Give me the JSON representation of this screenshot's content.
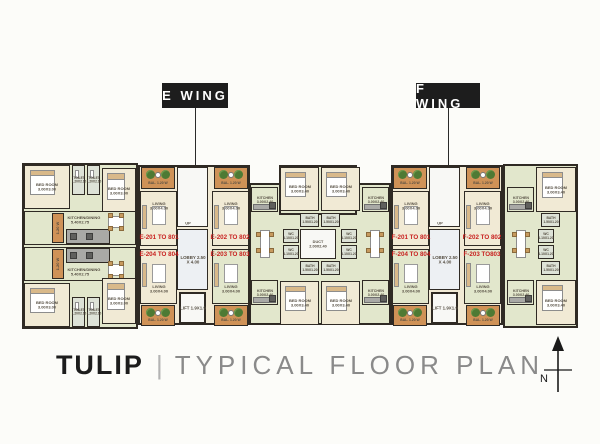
{
  "wing_labels": {
    "e": "E WING",
    "f": "F WING"
  },
  "title": {
    "name": "TULIP",
    "separator": "|",
    "subtitle": "TYPICAL FLOOR PLAN"
  },
  "north_label": "N",
  "colors": {
    "wall": "#2f2a24",
    "cream": "#f1ead5",
    "green": "#e2e7cc",
    "bal": "#cf9257",
    "bath": "#dde2d7",
    "white": "#f8f8f5",
    "lobby": "#edf0f3",
    "gray": "#a9a9a6",
    "red": "#c8201f",
    "ink": "#554e42"
  },
  "plan": {
    "footprints": [
      {
        "x": 22,
        "y": 163,
        "w": 116,
        "h": 166,
        "f": "green"
      },
      {
        "x": 138,
        "y": 165,
        "w": 112,
        "h": 160,
        "f": "cream"
      },
      {
        "x": 249,
        "y": 183,
        "w": 142,
        "h": 142,
        "f": "green"
      },
      {
        "x": 279,
        "y": 165,
        "w": 78,
        "h": 50,
        "f": "green"
      },
      {
        "x": 391,
        "y": 165,
        "w": 112,
        "h": 160,
        "f": "cream"
      },
      {
        "x": 503,
        "y": 164,
        "w": 75,
        "h": 164,
        "f": "green"
      }
    ],
    "rooms": [
      {
        "x": 24,
        "y": 165,
        "w": 46,
        "h": 44,
        "f": "cream",
        "l": "BED ROOM 3.00X3.00",
        "t": "bedroom"
      },
      {
        "x": 72,
        "y": 165,
        "w": 13,
        "h": 30,
        "f": "bath",
        "l": "TOILET 1.20X2.10",
        "ls": 0.4,
        "t": "wet"
      },
      {
        "x": 87,
        "y": 165,
        "w": 13,
        "h": 30,
        "f": "bath",
        "l": "TOILET 1.20X2.10",
        "ls": 0.4,
        "t": "wet"
      },
      {
        "x": 102,
        "y": 168,
        "w": 34,
        "h": 46,
        "f": "cream",
        "l": "BED ROOM 3.00X3.00",
        "t": "bedroom"
      },
      {
        "x": 24,
        "y": 211,
        "w": 112,
        "h": 34,
        "f": "green",
        "l": "KITCHEN/DINING 5.40X2.75",
        "lp": "t"
      },
      {
        "x": 24,
        "y": 247,
        "w": 112,
        "h": 34,
        "f": "green",
        "l": "KITCHEN/DINING 5.40X2.75",
        "lp": "b"
      },
      {
        "x": 52,
        "y": 213,
        "w": 12,
        "h": 30,
        "f": "bal",
        "l": "1.20 W",
        "rot": true
      },
      {
        "x": 52,
        "y": 249,
        "w": 12,
        "h": 30,
        "f": "bal",
        "l": "1.20 W",
        "rot": true
      },
      {
        "x": 66,
        "y": 229,
        "w": 44,
        "h": 15,
        "f": "gray",
        "t": "counter"
      },
      {
        "x": 66,
        "y": 248,
        "w": 44,
        "h": 15,
        "f": "gray",
        "t": "counter"
      },
      {
        "x": 104,
        "y": 214,
        "w": 24,
        "h": 16,
        "t": "table"
      },
      {
        "x": 104,
        "y": 262,
        "w": 24,
        "h": 16,
        "t": "table"
      },
      {
        "x": 24,
        "y": 283,
        "w": 46,
        "h": 44,
        "f": "cream",
        "l": "BED ROOM 3.00X3.00",
        "t": "bedroom"
      },
      {
        "x": 102,
        "y": 278,
        "w": 34,
        "h": 46,
        "f": "cream",
        "l": "BED ROOM 3.00X3.00",
        "t": "bedroom"
      },
      {
        "x": 72,
        "y": 297,
        "w": 13,
        "h": 30,
        "f": "bath",
        "l": "TOILET 1.20X2.10",
        "ls": 0.4,
        "t": "wet"
      },
      {
        "x": 87,
        "y": 297,
        "w": 13,
        "h": 30,
        "f": "bath",
        "l": "TOILET 1.20X2.10",
        "ls": 0.4,
        "t": "wet"
      },
      {
        "x": 141,
        "y": 167,
        "w": 34,
        "h": 22,
        "f": "bal",
        "l": "BAL. 1.20 W",
        "lp": "b",
        "ls": 0.42,
        "t": "balcony"
      },
      {
        "x": 140,
        "y": 191,
        "w": 37,
        "h": 55,
        "f": "cream",
        "l": "LIVING 3.00X4.00",
        "lp": "t",
        "t": "living"
      },
      {
        "x": 177,
        "y": 167,
        "w": 31,
        "h": 60,
        "f": "white",
        "t": "stairs"
      },
      {
        "x": 177,
        "y": 229,
        "w": 31,
        "h": 61,
        "f": "lobby",
        "l": "LOBBY 2.50 X 4.00",
        "ls": 0.55
      },
      {
        "x": 179,
        "y": 292,
        "w": 27,
        "h": 32,
        "f": "white",
        "l": "LIFT 1.9X1.9",
        "ls": 0.55,
        "t": "lift"
      },
      {
        "x": 214,
        "y": 167,
        "w": 34,
        "h": 22,
        "f": "bal",
        "l": "BAL. 1.20 W",
        "lp": "b",
        "ls": 0.42,
        "t": "balcony"
      },
      {
        "x": 212,
        "y": 191,
        "w": 37,
        "h": 55,
        "f": "cream",
        "l": "LIVING 3.00X4.00",
        "lp": "t",
        "t": "living"
      },
      {
        "x": 140,
        "y": 249,
        "w": 37,
        "h": 55,
        "f": "cream",
        "l": "LIVING 3.00X4.00",
        "lp": "b",
        "t": "living"
      },
      {
        "x": 141,
        "y": 305,
        "w": 34,
        "h": 21,
        "f": "bal",
        "l": "BAL. 1.20 W",
        "lp": "b",
        "ls": 0.42,
        "t": "balcony"
      },
      {
        "x": 212,
        "y": 249,
        "w": 37,
        "h": 55,
        "f": "green",
        "l": "LIVING 3.00X4.00",
        "lp": "b",
        "t": "living"
      },
      {
        "x": 214,
        "y": 305,
        "w": 34,
        "h": 21,
        "f": "bal",
        "l": "BAL. 1.20 W",
        "lp": "b",
        "ls": 0.42,
        "t": "balcony"
      },
      {
        "x": 251,
        "y": 187,
        "w": 27,
        "h": 25,
        "f": "green",
        "l": "KITCHEN 3.00X2.40",
        "ls": 0.45,
        "t": "kitchen"
      },
      {
        "x": 280,
        "y": 167,
        "w": 39,
        "h": 44,
        "f": "cream",
        "l": "BED ROOM 3.00X3.40",
        "t": "bedroom"
      },
      {
        "x": 300,
        "y": 213,
        "w": 19,
        "h": 14,
        "f": "bath",
        "l": "BATH 1.50X1.20",
        "ls": 0.42
      },
      {
        "x": 283,
        "y": 229,
        "w": 16,
        "h": 14,
        "f": "bath",
        "l": "WC 1.10X1.20",
        "ls": 0.42
      },
      {
        "x": 283,
        "y": 245,
        "w": 16,
        "h": 14,
        "f": "bath",
        "l": "WC 1.10X1.20",
        "ls": 0.42
      },
      {
        "x": 300,
        "y": 229,
        "w": 36,
        "h": 30,
        "f": "white",
        "l": "DUCT 2.00X2.40",
        "ls": 0.48,
        "t": "duct"
      },
      {
        "x": 300,
        "y": 261,
        "w": 19,
        "h": 14,
        "f": "bath",
        "l": "BATH 1.50X1.20",
        "ls": 0.42
      },
      {
        "x": 280,
        "y": 281,
        "w": 39,
        "h": 44,
        "f": "cream",
        "l": "BED ROOM 3.00X3.40",
        "t": "bedroom"
      },
      {
        "x": 251,
        "y": 280,
        "w": 27,
        "h": 25,
        "f": "green",
        "l": "KITCHEN 3.00X2.40",
        "ls": 0.45,
        "t": "kitchen"
      },
      {
        "x": 257,
        "y": 226,
        "w": 16,
        "h": 36,
        "t": "table"
      },
      {
        "x": 321,
        "y": 167,
        "w": 39,
        "h": 44,
        "f": "cream",
        "l": "BED ROOM 3.00X3.40",
        "t": "bedroom"
      },
      {
        "x": 321,
        "y": 213,
        "w": 19,
        "h": 14,
        "f": "bath",
        "l": "BATH 1.50X1.20",
        "ls": 0.42
      },
      {
        "x": 341,
        "y": 229,
        "w": 16,
        "h": 14,
        "f": "bath",
        "l": "WC 1.10X1.20",
        "ls": 0.42
      },
      {
        "x": 341,
        "y": 245,
        "w": 16,
        "h": 14,
        "f": "bath",
        "l": "WC 1.10X1.20",
        "ls": 0.42
      },
      {
        "x": 321,
        "y": 261,
        "w": 19,
        "h": 14,
        "f": "bath",
        "l": "BATH 1.50X1.20",
        "ls": 0.42
      },
      {
        "x": 321,
        "y": 281,
        "w": 39,
        "h": 44,
        "f": "cream",
        "l": "BED ROOM 3.00X3.40",
        "t": "bedroom"
      },
      {
        "x": 362,
        "y": 187,
        "w": 27,
        "h": 25,
        "f": "green",
        "l": "KITCHEN 3.00X2.40",
        "ls": 0.45,
        "t": "kitchen"
      },
      {
        "x": 362,
        "y": 280,
        "w": 27,
        "h": 25,
        "f": "green",
        "l": "KITCHEN 3.00X2.40",
        "ls": 0.45,
        "t": "kitchen"
      },
      {
        "x": 367,
        "y": 226,
        "w": 16,
        "h": 36,
        "t": "table"
      },
      {
        "x": 393,
        "y": 167,
        "w": 34,
        "h": 22,
        "f": "bal",
        "l": "BAL. 1.20 W",
        "lp": "b",
        "ls": 0.42,
        "t": "balcony"
      },
      {
        "x": 392,
        "y": 191,
        "w": 37,
        "h": 55,
        "f": "cream",
        "l": "LIVING 3.00X4.00",
        "lp": "t",
        "t": "living"
      },
      {
        "x": 429,
        "y": 167,
        "w": 31,
        "h": 60,
        "f": "white",
        "t": "stairs"
      },
      {
        "x": 429,
        "y": 229,
        "w": 31,
        "h": 61,
        "f": "lobby",
        "l": "LOBBY 2.50 X 4.00",
        "ls": 0.55
      },
      {
        "x": 431,
        "y": 292,
        "w": 27,
        "h": 32,
        "f": "white",
        "l": "LIFT 1.9X1.9",
        "ls": 0.55,
        "t": "lift"
      },
      {
        "x": 466,
        "y": 167,
        "w": 34,
        "h": 22,
        "f": "bal",
        "l": "BAL. 1.20 W",
        "lp": "b",
        "ls": 0.42,
        "t": "balcony"
      },
      {
        "x": 464,
        "y": 191,
        "w": 37,
        "h": 55,
        "f": "cream",
        "l": "LIVING 3.00X4.00",
        "lp": "t",
        "t": "living"
      },
      {
        "x": 392,
        "y": 249,
        "w": 37,
        "h": 55,
        "f": "green",
        "l": "LIVING 3.00X4.00",
        "lp": "b",
        "t": "living"
      },
      {
        "x": 393,
        "y": 305,
        "w": 34,
        "h": 21,
        "f": "bal",
        "l": "BAL. 1.20 W",
        "lp": "b",
        "ls": 0.42,
        "t": "balcony"
      },
      {
        "x": 464,
        "y": 249,
        "w": 37,
        "h": 55,
        "f": "green",
        "l": "LIVING 3.00X4.00",
        "lp": "b",
        "t": "living"
      },
      {
        "x": 466,
        "y": 305,
        "w": 34,
        "h": 21,
        "f": "bal",
        "l": "BAL. 1.20 W",
        "lp": "b",
        "ls": 0.42,
        "t": "balcony"
      },
      {
        "x": 507,
        "y": 187,
        "w": 27,
        "h": 25,
        "f": "green",
        "l": "KITCHEN 3.00X2.40",
        "ls": 0.45,
        "t": "kitchen"
      },
      {
        "x": 513,
        "y": 226,
        "w": 16,
        "h": 36,
        "t": "table"
      },
      {
        "x": 507,
        "y": 280,
        "w": 27,
        "h": 25,
        "f": "green",
        "l": "KITCHEN 3.00X2.40",
        "ls": 0.45,
        "t": "kitchen"
      },
      {
        "x": 536,
        "y": 167,
        "w": 40,
        "h": 45,
        "f": "cream",
        "l": "BED ROOM 3.00X3.40",
        "t": "bedroom"
      },
      {
        "x": 541,
        "y": 213,
        "w": 19,
        "h": 14,
        "f": "bath",
        "l": "BATH 1.50X1.20",
        "ls": 0.42
      },
      {
        "x": 538,
        "y": 229,
        "w": 16,
        "h": 14,
        "f": "bath",
        "l": "WC 1.10X1.20",
        "ls": 0.42
      },
      {
        "x": 538,
        "y": 245,
        "w": 16,
        "h": 14,
        "f": "bath",
        "l": "WC 1.10X1.20",
        "ls": 0.42
      },
      {
        "x": 541,
        "y": 261,
        "w": 19,
        "h": 14,
        "f": "bath",
        "l": "BATH 1.50X1.20",
        "ls": 0.42
      },
      {
        "x": 536,
        "y": 280,
        "w": 40,
        "h": 45,
        "f": "cream",
        "l": "BED ROOM 3.00X3.40",
        "t": "bedroom"
      }
    ],
    "labels": [
      {
        "t": "UP",
        "x": 188,
        "y": 223,
        "c": "ink",
        "s": 0.5
      },
      {
        "t": "UP",
        "x": 440,
        "y": 223,
        "c": "ink",
        "s": 0.5
      },
      {
        "t": "E-201 TO 801",
        "x": 159,
        "y": 237,
        "c": "red",
        "s": 0.78
      },
      {
        "t": "E-204 TO 804",
        "x": 159,
        "y": 254,
        "c": "red",
        "s": 0.78
      },
      {
        "t": "E-202 TO 802",
        "x": 230,
        "y": 237,
        "c": "red",
        "s": 0.78
      },
      {
        "t": "E-203 TO 803",
        "x": 230,
        "y": 254,
        "c": "red",
        "s": 0.78
      },
      {
        "t": "F-201 TO 801",
        "x": 411,
        "y": 237,
        "c": "red",
        "s": 0.78
      },
      {
        "t": "F-204 TO 804",
        "x": 411,
        "y": 254,
        "c": "red",
        "s": 0.78
      },
      {
        "t": "F-202 TO 802",
        "x": 482,
        "y": 237,
        "c": "red",
        "s": 0.78
      },
      {
        "t": "F-203 TO803",
        "x": 482,
        "y": 254,
        "c": "red",
        "s": 0.78
      }
    ]
  },
  "geometry": {
    "e_wing_box": {
      "x": 162,
      "y": 83,
      "w": 66,
      "h": 25
    },
    "f_wing_box": {
      "x": 416,
      "y": 83,
      "w": 64,
      "h": 25
    },
    "e_leader": {
      "x": 195,
      "y1": 108,
      "y2": 166
    },
    "f_leader": {
      "x": 448,
      "y1": 108,
      "y2": 166
    }
  }
}
